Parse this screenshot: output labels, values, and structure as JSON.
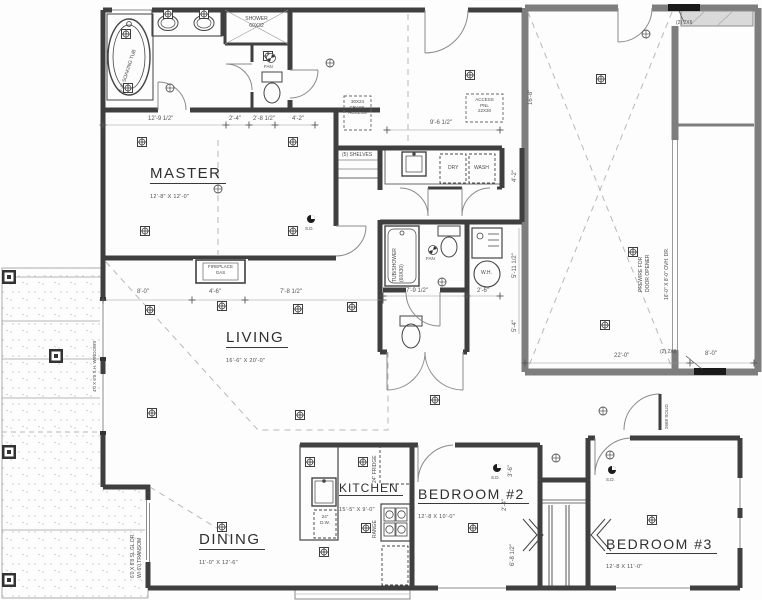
{
  "colors": {
    "wall": "#3f3f3f",
    "garage_wall": "#7e7e7e",
    "dash": "#b8b8b8",
    "dim_text": "#555555",
    "label_text": "#2f2f2f",
    "patio_mark": "#bdbdbd"
  },
  "rooms": {
    "master": {
      "name": "MASTER",
      "dims": "12'-8\" X 12'-0\""
    },
    "living": {
      "name": "LIVING",
      "dims": "16'-6\" X 20'-0\""
    },
    "dining": {
      "name": "DINING",
      "dims": "11'-0\" X 12'-6\""
    },
    "kitchen": {
      "name": "KITCHEN",
      "dims": "15'-5\" X 9'-0\""
    },
    "bedroom2": {
      "name": "BEDROOM #2",
      "dims": "12'-8 X 10'-0\""
    },
    "bedroom3": {
      "name": "BEDROOM #3",
      "dims": "12'-8 X 11'-0\""
    }
  },
  "fixtures": {
    "soaking_tub": "6'-0\" SOAKING TUB",
    "master_shower_1": "SHOWER",
    "master_shower_2": "60X32",
    "fan": "FAN",
    "fireplace_1": "FIREPLACE",
    "fireplace_2": "GAS",
    "hall_tub_1": "TUB/SHOWER",
    "hall_tub_2": "(60X30)",
    "water_heater": "W.H.",
    "dryer": "DRY",
    "washer": "WASH",
    "shelves": "(5) SHELVES",
    "dishwasher_1": "24\"",
    "dishwasher_2": "D.W.",
    "fridge": "24\" FRIDGE",
    "range": "RANGE",
    "smoke_detector": "S.D."
  },
  "notes": {
    "crawl_access_1": "30X24",
    "crawl_access_2": "CRAWL",
    "crawl_access_3": "ACCESS",
    "access_panel_1": "ACCESS",
    "access_panel_2": "PNL",
    "access_panel_3": "22X30",
    "sliding_door_1": "6'0 X 6'8 SL.GL.DR.",
    "sliding_door_2": "W/ 6'0 TRANSOM",
    "window_note": "4'0 X 6'0 S.H. WINDOWS",
    "overhead_door": "16'-0\" X 8'-0\" OVH. DR.",
    "prewire_1": "PREWIRE FOR",
    "prewire_2": "DOOR OPENER",
    "header": "(2) 2X6",
    "garage_entry_door": "2668 SOLID"
  },
  "dimensions": {
    "mbath_1": "12'-9 1/2\"",
    "mbath_2": "2'-4\"",
    "mbath_3": "2'-8 1/2\"",
    "mbath_4": "4'-2\"",
    "hall": "9'-6 1/2\"",
    "master_1": "8'-0\"",
    "master_2": "4'-6\"",
    "master_3": "7'-8 1/2\"",
    "bath_1": "7'-9 1/2\"",
    "bath_2": "2'-6\"",
    "bath_v1": "5'-11 1/2\"",
    "bath_v2": "5'-4\"",
    "laundry_v": "4'-2\"",
    "garage_1": "22'-0\"",
    "garage_2": "8'-0\"",
    "garage_v": "16'-8\"",
    "bed2_v1": "3'-6\"",
    "bed2_v2": "2'-4\"",
    "bed2_v3": "6'-8 1/2\""
  }
}
